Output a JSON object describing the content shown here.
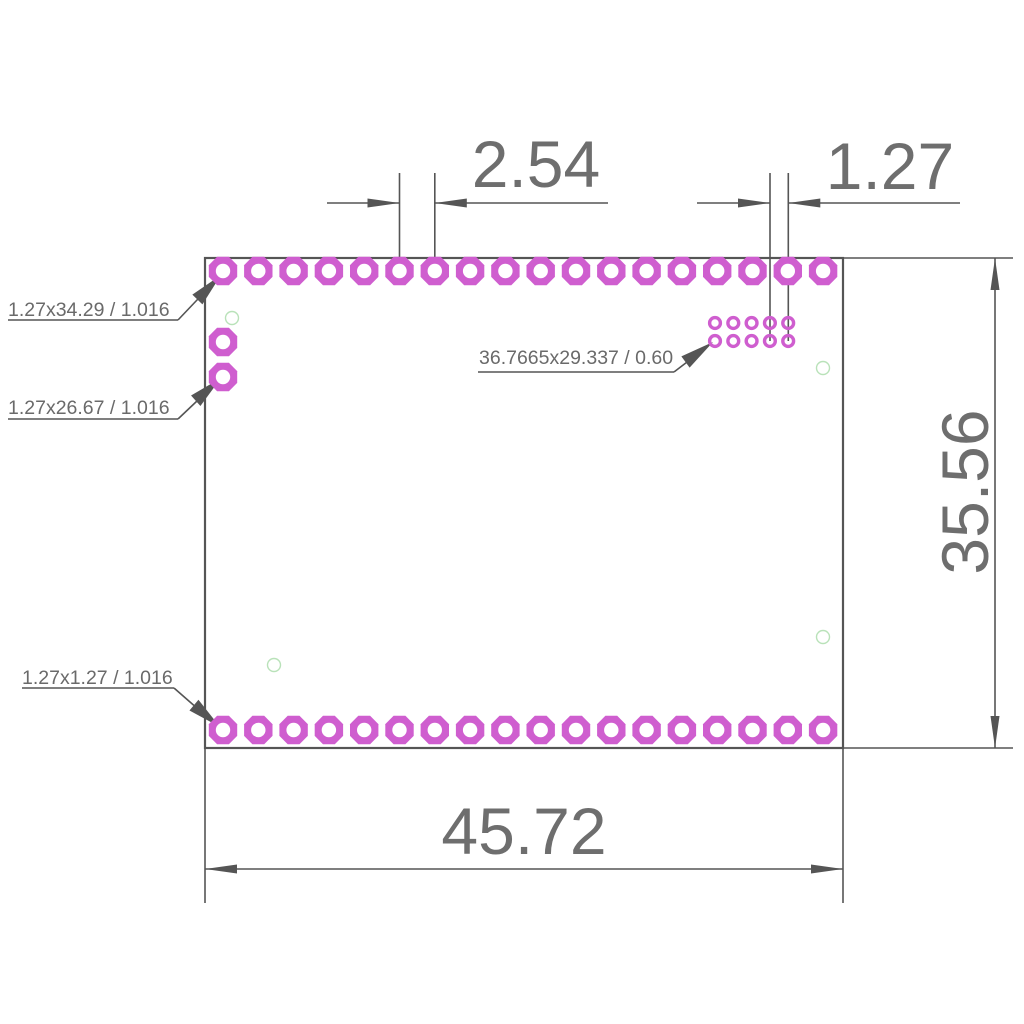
{
  "drawing": {
    "background": "#ffffff",
    "colors": {
      "pad_magenta": "#cf5ecf",
      "hole_green": "#b9e2b9",
      "line_gray": "#555555",
      "text_gray": "#6e6e6e",
      "pad_hole_white": "#ffffff"
    },
    "board_outline": {
      "x": 205,
      "y": 258,
      "width": 638,
      "height": 490,
      "stroke_width": 2.2
    },
    "pad_style": {
      "outer_radius": 15.4,
      "hole_radius": 7.2
    },
    "pad_rows": [
      {
        "name": "top-row",
        "count": 18,
        "x0": 223,
        "y": 271,
        "dx": 35.3
      },
      {
        "name": "bottom-row",
        "count": 18,
        "x0": 223,
        "y": 730,
        "dx": 35.3
      },
      {
        "name": "left-col-upper",
        "count": 1,
        "x0": 223,
        "y": 342,
        "dx": 0
      },
      {
        "name": "left-col-lower",
        "count": 1,
        "x0": 223,
        "y": 377,
        "dx": 0
      }
    ],
    "pad_grid": {
      "cols": 5,
      "rows": 2,
      "x0": 715,
      "y0": 323,
      "dx": 18.3,
      "dy": 18,
      "r": 5.4,
      "stroke_width": 3.4
    },
    "green_holes": {
      "r": 6.5,
      "stroke_width": 1.4,
      "points": [
        [
          232,
          318
        ],
        [
          274,
          665
        ],
        [
          823,
          368
        ],
        [
          823,
          637
        ]
      ]
    },
    "lines": [
      [
        399.5,
        173,
        399.5,
        278
      ],
      [
        434.8,
        173,
        434.8,
        278
      ],
      [
        327,
        203,
        399.5,
        203
      ],
      [
        434.8,
        203,
        608,
        203
      ],
      [
        770,
        173,
        770,
        341
      ],
      [
        788.3,
        173,
        788.3,
        341
      ],
      [
        697,
        203,
        770,
        203
      ],
      [
        788.3,
        203,
        960,
        203
      ],
      [
        843,
        258,
        1013,
        258
      ],
      [
        843,
        748,
        1013,
        748
      ],
      [
        995,
        258,
        995,
        748
      ],
      [
        205,
        748,
        205,
        903
      ],
      [
        843,
        748,
        843,
        903
      ],
      [
        205,
        869,
        843,
        869
      ],
      [
        8,
        320,
        178,
        320
      ],
      [
        178,
        320,
        216,
        280
      ],
      [
        8,
        419,
        178,
        419
      ],
      [
        178,
        419,
        216,
        383
      ],
      [
        22,
        688,
        174,
        688
      ],
      [
        174,
        688,
        214,
        723
      ],
      [
        478,
        372,
        674,
        372
      ],
      [
        674,
        372,
        708,
        346
      ]
    ],
    "arrows": [
      {
        "x": 399.5,
        "y": 203,
        "angle": 0,
        "len": 32,
        "w": 9
      },
      {
        "x": 434.8,
        "y": 203,
        "angle": 180,
        "len": 32,
        "w": 9
      },
      {
        "x": 770,
        "y": 203,
        "angle": 0,
        "len": 32,
        "w": 9
      },
      {
        "x": 788.3,
        "y": 203,
        "angle": 180,
        "len": 32,
        "w": 9
      },
      {
        "x": 995,
        "y": 258,
        "angle": -90,
        "len": 32,
        "w": 9
      },
      {
        "x": 995,
        "y": 748,
        "angle": 90,
        "len": 32,
        "w": 9
      },
      {
        "x": 205,
        "y": 869,
        "angle": 180,
        "len": 32,
        "w": 9
      },
      {
        "x": 843,
        "y": 869,
        "angle": 0,
        "len": 32,
        "w": 9
      },
      {
        "x": 221,
        "y": 275,
        "angle": -46,
        "len": 34,
        "w": 14
      },
      {
        "x": 221,
        "y": 378,
        "angle": -42,
        "len": 34,
        "w": 14
      },
      {
        "x": 220,
        "y": 727,
        "angle": 40,
        "len": 34,
        "w": 14
      },
      {
        "x": 713,
        "y": 342,
        "angle": -36,
        "len": 34,
        "w": 14
      }
    ],
    "dimensions": {
      "pitch_wide": "2.54",
      "pitch_narrow": "1.27",
      "board_width": "45.72",
      "board_height": "35.56"
    },
    "notes": {
      "pad_top_left": "1.27x34.29 / 1.016",
      "pad_left_lower": "1.27x26.67 / 1.016",
      "pad_bottom_left": "1.27x1.27 / 1.016",
      "smd_grid": "36.7665x29.337 / 0.60"
    }
  }
}
